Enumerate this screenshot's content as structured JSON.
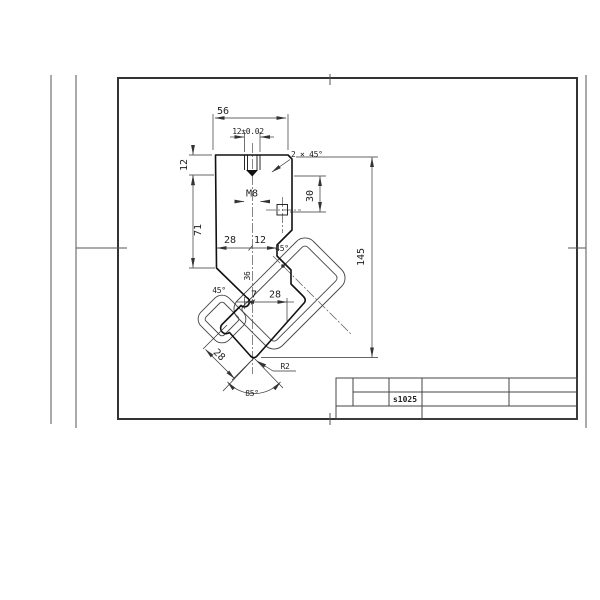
{
  "title_block": {
    "part_code": "s1025"
  },
  "dimensions": {
    "width_top": "56",
    "slot_width": "12±0.02",
    "chamfer": "2 × 45°",
    "tang_height": "12",
    "body_height": "71",
    "thread": "M8",
    "square_depth": "30",
    "total_height": "145",
    "left_half": "28",
    "center_offset": "12",
    "notch_angle": "45°",
    "slope_angle": "45°",
    "diag_dim": "36",
    "tip_left": "7",
    "tip_right": "28",
    "ear_width": "28",
    "tip_radius": "R2",
    "vee_angle": "85°"
  },
  "colors": {
    "line": "#333333",
    "background": "#ffffff"
  }
}
